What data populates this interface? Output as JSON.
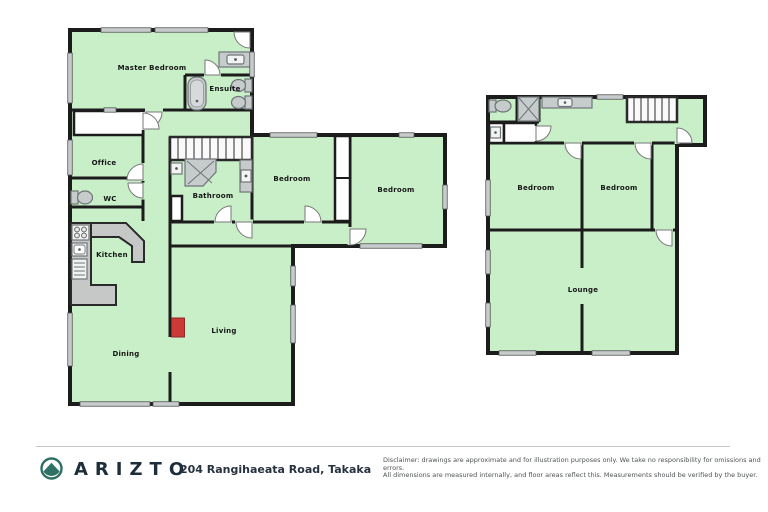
{
  "floorplan": {
    "ground_floor": {
      "rooms": [
        {
          "label": "Master Bedroom"
        },
        {
          "label": "Ensuite"
        },
        {
          "label": "Office"
        },
        {
          "label": "WC"
        },
        {
          "label": "Kitchen"
        },
        {
          "label": "Bathroom"
        },
        {
          "label": "Bedroom"
        },
        {
          "label": "Bedroom"
        },
        {
          "label": "Dining"
        },
        {
          "label": "Living"
        }
      ]
    },
    "upper_floor": {
      "rooms": [
        {
          "label": "Bedroom"
        },
        {
          "label": "Bedroom"
        },
        {
          "label": "Lounge"
        }
      ]
    },
    "colors": {
      "floor_fill": "#c9efc9",
      "wall": "#1c1c1c",
      "fixture_gray": "#c6cbcc",
      "window_gray": "#c6cbcc",
      "fireplace_red": "#cc3a36"
    }
  },
  "footer": {
    "brand": "ARIZTO",
    "address": "204 Rangihaeata Road, Takaka",
    "disclaimer_line1": "Disclaimer: drawings are approximate and for illustration purposes only. We take no responsibility for omissions and errors.",
    "disclaimer_line2": "All dimensions are measured internally, and floor areas reflect this. Measurements should be verified by the buyer.",
    "brand_color": "#1d2d3a",
    "logo_teal": "#2e6f63"
  }
}
